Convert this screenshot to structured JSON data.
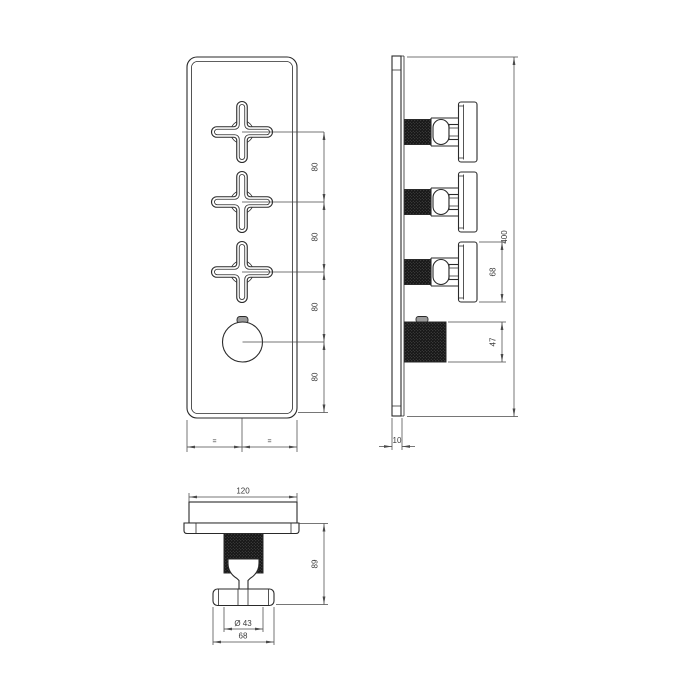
{
  "drawing": {
    "views": {
      "front": {
        "spacing_dims": [
          "80",
          "80",
          "80",
          "80"
        ],
        "equal_marks": [
          "=",
          "="
        ]
      },
      "side": {
        "overall_height": "400",
        "handle_height": "68",
        "knob_diameter": "47",
        "plate_thickness": "10"
      },
      "bottom": {
        "plate_width": "120",
        "knurl_diameter": "Ø 43",
        "handle_width": "68",
        "handle_depth": "89"
      }
    },
    "colors": {
      "line": "#2a2a2a",
      "dim_line": "#4a4a4a",
      "text": "#3a3a3a",
      "knurl_dark": "#161616",
      "background": "#ffffff"
    }
  }
}
